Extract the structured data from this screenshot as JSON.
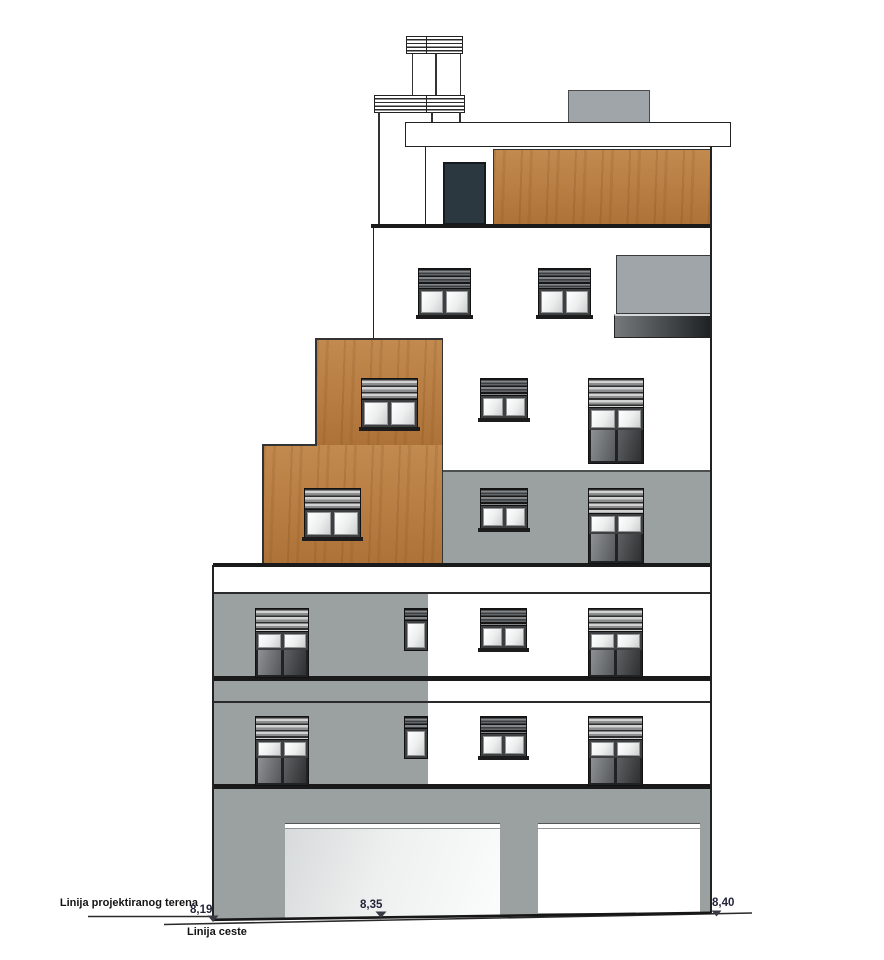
{
  "annotations": {
    "terrain_label": "Linija projektiranog terena",
    "road_label": "Linija ceste",
    "level_left": "8,19",
    "level_center": "8,35",
    "level_right": "8,40"
  },
  "colors": {
    "facade_gray": "#9ba0a1",
    "accent_wood": "#b97f44",
    "dark_door": "#2c3840",
    "panel_gray": "#9fa5a8",
    "line": "#1a1a1a"
  }
}
